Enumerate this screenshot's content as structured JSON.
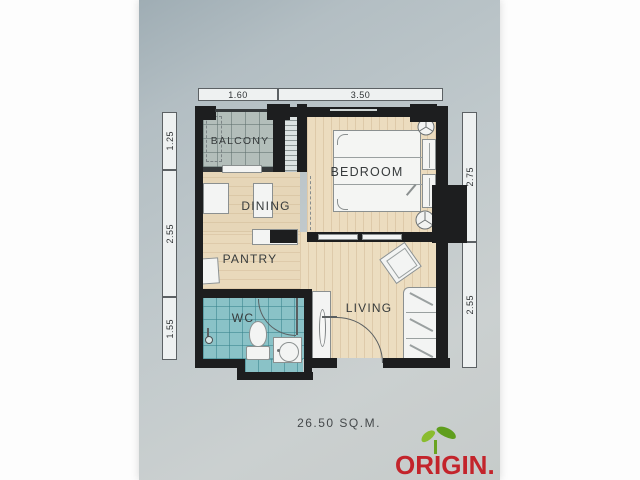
{
  "photo": {
    "area_label": "26.50 SQ.M.",
    "logo_text": "ORIGIN.",
    "rooms": {
      "balcony": "BALCONY",
      "bedroom": "BEDROOM",
      "dining": "DINING",
      "pantry": "PANTRY",
      "wc": "WC",
      "living": "LIVING"
    },
    "dims": {
      "top": [
        "1.60",
        "3.50"
      ],
      "left": [
        "1.25",
        "2.55",
        "1.55"
      ],
      "right": [
        "2.75",
        "2.55"
      ]
    },
    "colors": {
      "paper": "#bfc8cb",
      "wall": "#1d1e1f",
      "wood_floor": "#e9d9bb",
      "balcony_tile": "#b3beba",
      "wc_tile": "#8ac2c7",
      "logo_red": "#c3242b",
      "leaf_green": "#7db32a"
    }
  }
}
